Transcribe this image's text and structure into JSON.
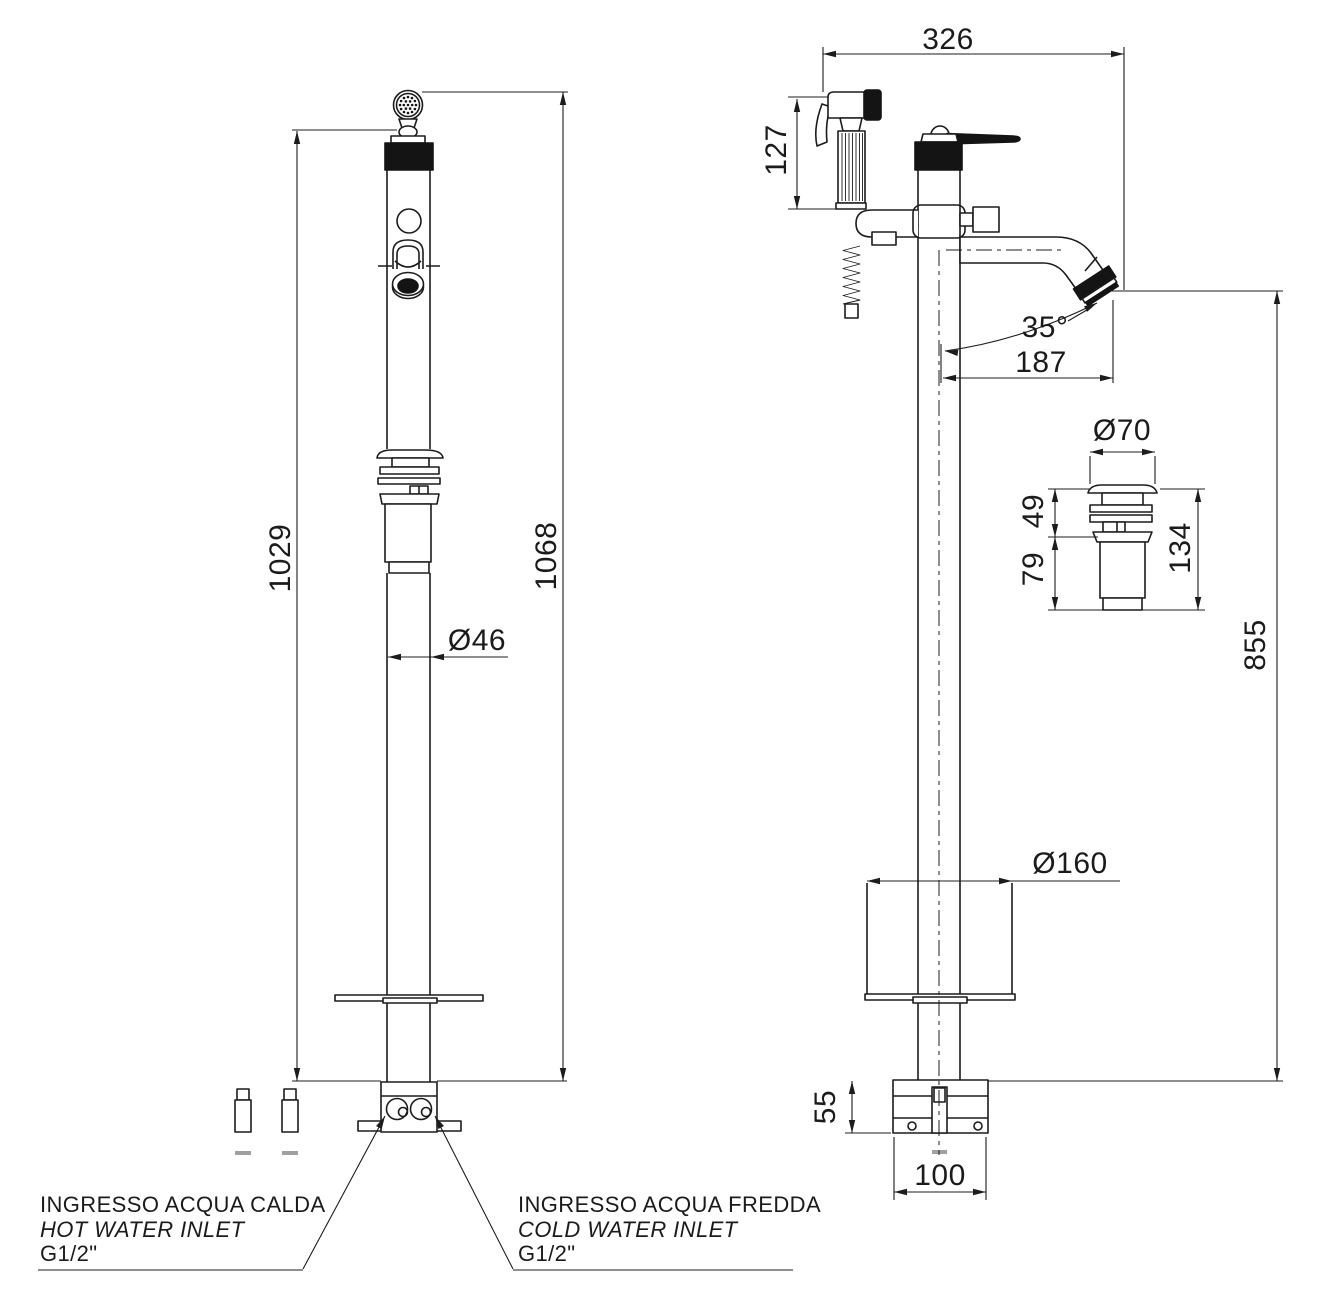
{
  "drawing_title": "freestanding-bidet-mixer-technical-drawing",
  "colors": {
    "line": "#1c1c1c",
    "fill_dark": "#141414",
    "fill_gray": "#a0a0a0",
    "background": "#ffffff"
  },
  "dims": {
    "front_height_spray": "1029",
    "front_height_total": "1068",
    "column_diameter": "Ø46",
    "side_width": "326",
    "handspray_height": "127",
    "spout_angle": "35°",
    "spout_reach": "187",
    "drain_cap_diameter": "Ø70",
    "drain_top_height": "49",
    "drain_bottom_height": "79",
    "drain_total_height": "134",
    "spout_height_floor": "855",
    "base_cover_diameter": "Ø160",
    "base_height": "55",
    "base_width": "100"
  },
  "labels": {
    "hot": {
      "l1": "INGRESSO ACQUA CALDA",
      "l2": "HOT WATER INLET",
      "l3": "G1/2\""
    },
    "cold": {
      "l1": "INGRESSO ACQUA FREDDA",
      "l2": "COLD WATER INLET",
      "l3": "G1/2\""
    }
  }
}
